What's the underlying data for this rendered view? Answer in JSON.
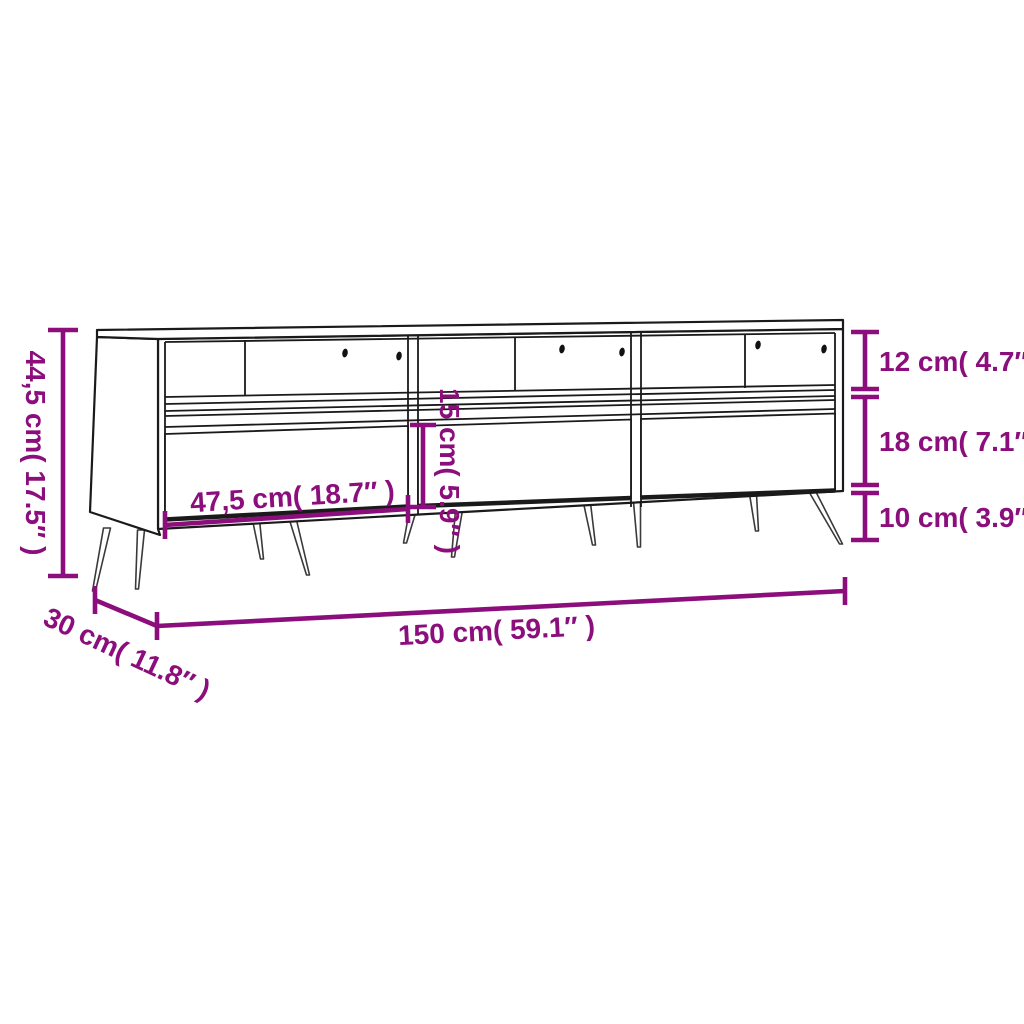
{
  "page": {
    "background": "#ffffff"
  },
  "diagram": {
    "subject": "tv-cabinet-dimension-diagram",
    "colors": {
      "dimension_accent": "#8B0E7C",
      "outline": "#1A1A1A",
      "leg_outline": "#3A3A3A",
      "background": "#FFFFFF"
    },
    "labels": {
      "overall_height": "44,5 cm( 17.5″ )",
      "compartment_height": "12 cm( 4.7″ )",
      "drawer_front_height": "18 cm( 7.1″ )",
      "leg_clearance": "10 cm( 3.9″ )",
      "drawer_width": "47,5 cm( 18.7″ )",
      "inner_height": "15 cm( 5.9″ )",
      "overall_width": "150 cm( 59.1″ )",
      "depth": "30 cm( 11.8″ )"
    }
  }
}
